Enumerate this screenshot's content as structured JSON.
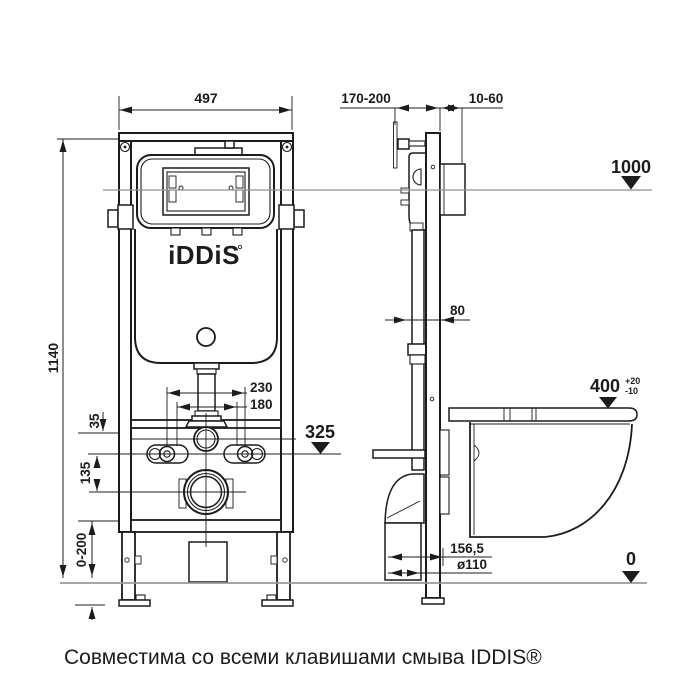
{
  "colors": {
    "ink": "#1c1c1c",
    "reference_line": "#8f8f8f",
    "floor_line": "#9a9a9a",
    "background": "#ffffff"
  },
  "logo": {
    "text": "iDDiS"
  },
  "caption": "Совместима со всеми клавишами смыва IDDIS®",
  "front_view": {
    "dim_width": "497",
    "dim_height": "1140",
    "dim_bolt_outer": "230",
    "dim_bolt_inner": "180",
    "dim_offset_small": "35",
    "dim_offset_large": "135",
    "dim_leg_range": "0-200",
    "level_drain": "325"
  },
  "side_view": {
    "dim_depth": "170-200",
    "dim_wall_gap": "10-60",
    "level_button": "1000",
    "dim_profile": "80",
    "level_seat": "400",
    "level_seat_tol_plus": "+20",
    "level_seat_tol_minus": "-10",
    "dim_outlet_offset": "156,5",
    "dim_outlet_diameter": "ø110",
    "level_floor": "0"
  }
}
